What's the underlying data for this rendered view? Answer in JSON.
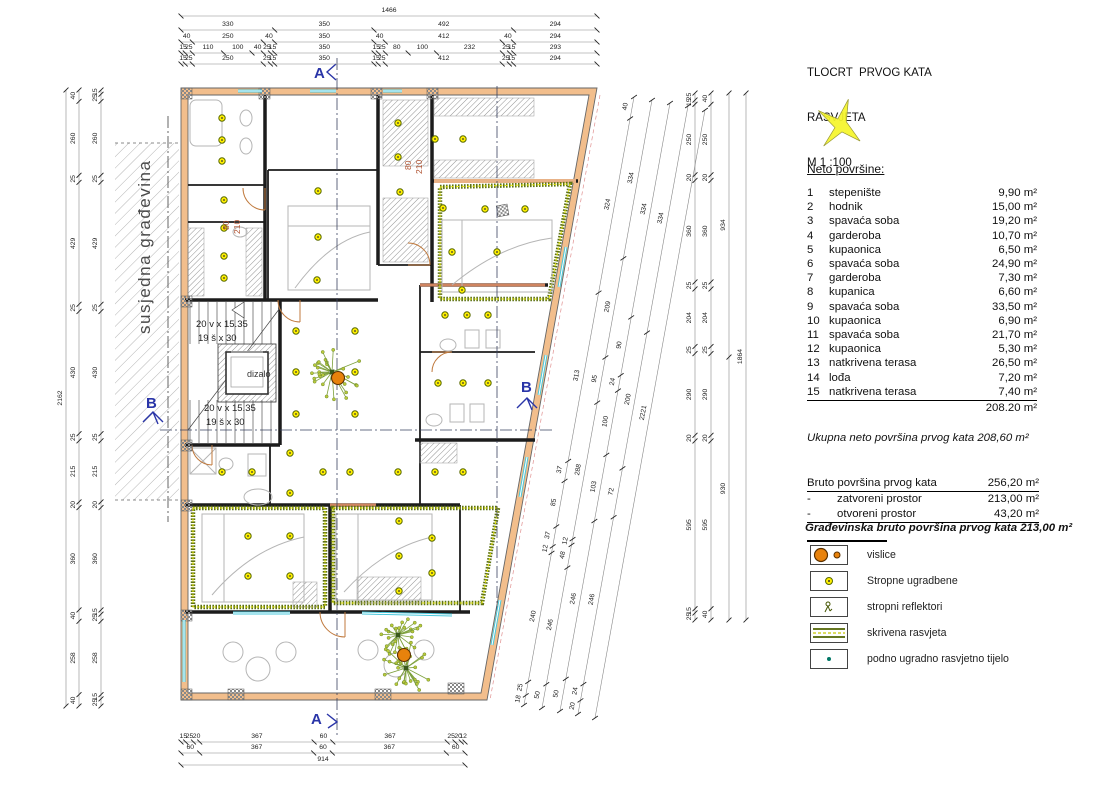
{
  "title": {
    "line1": "TLOCRT  PRVOG KATA",
    "line2": "RASVJETA",
    "scale": "M 1 :100"
  },
  "neto": {
    "heading": "Neto površine:",
    "rows": [
      {
        "num": "1",
        "name": "stepenište",
        "area": "9,90 m²"
      },
      {
        "num": "2",
        "name": "hodnik",
        "area": "15,00 m²"
      },
      {
        "num": "3",
        "name": "spavaća soba",
        "area": "19,20 m²"
      },
      {
        "num": "4",
        "name": "garderoba",
        "area": "10,70 m²"
      },
      {
        "num": "5",
        "name": "kupaonica",
        "area": "6,50 m²"
      },
      {
        "num": "6",
        "name": "spavaća soba",
        "area": "24,90 m²"
      },
      {
        "num": "7",
        "name": "garderoba",
        "area": "7,30 m²"
      },
      {
        "num": "8",
        "name": "kupanica",
        "area": "6,60 m²"
      },
      {
        "num": "9",
        "name": "spavaća soba",
        "area": "33,50 m²"
      },
      {
        "num": "10",
        "name": "kupaonica",
        "area": "6,90 m²"
      },
      {
        "num": "11",
        "name": "spavaća soba",
        "area": "21,70 m²"
      },
      {
        "num": "12",
        "name": "kupaonica",
        "area": "5,30 m²"
      },
      {
        "num": "13",
        "name": "natkrivena terasa",
        "area": "26,50 m²"
      },
      {
        "num": "14",
        "name": "lođa",
        "area": "7,20 m²"
      },
      {
        "num": "15",
        "name": "natkrivena terasa",
        "area": "7,40 m²"
      }
    ],
    "total": "208.20 m²"
  },
  "ukupna": "Ukupna neto površina  prvog kata  208,60 m²",
  "bruto": {
    "header": {
      "label": "Bruto površina prvog kata",
      "value": "256,20 m²"
    },
    "rows": [
      {
        "dash": "-",
        "label": "zatvoreni prostor",
        "value": "213,00 m²"
      },
      {
        "dash": "-",
        "label": "otvoreni prostor",
        "value": "43,20 m²"
      }
    ],
    "final": "Građevinska bruto površina prvog kata  213,00 m²"
  },
  "legend": {
    "items": [
      {
        "icon": "pendant-icon",
        "label": "vislice"
      },
      {
        "icon": "ceiling-recessed-icon",
        "label": "Stropne ugradbene"
      },
      {
        "icon": "spotlight-icon",
        "label": "stropni reflektori"
      },
      {
        "icon": "cove-lighting-icon",
        "label": "skrivena rasvjeta"
      },
      {
        "icon": "floor-light-icon",
        "label": "podno ugradno rasvjetno tijelo"
      }
    ]
  },
  "colors": {
    "wall": "#f2be8c",
    "wall_dark": "#cf8460",
    "light": "#ffef00",
    "cove": "#5f7313",
    "cove_dash": "#e8e80a",
    "window": "#49c8dc",
    "marker": "#2a35a8",
    "pendant": "#e8820c",
    "door": "#c07a3e",
    "dim": "#555555"
  },
  "plan": {
    "labels": [
      {
        "t": "A",
        "x": 314,
        "y": 78,
        "cls": "marker"
      },
      {
        "t": "A",
        "x": 311,
        "y": 724,
        "cls": "marker"
      },
      {
        "t": "B",
        "x": 146,
        "y": 408,
        "cls": "marker"
      },
      {
        "t": "B",
        "x": 521,
        "y": 392,
        "cls": "marker"
      },
      {
        "t": "dizalo",
        "x": 247,
        "y": 377,
        "cls": "small"
      },
      {
        "t": "20 v x 15.35",
        "x": 196,
        "y": 327,
        "cls": "stair"
      },
      {
        "t": "19 š x 30",
        "x": 198,
        "y": 341,
        "cls": "stair"
      },
      {
        "t": "20 v x 15.35",
        "x": 204,
        "y": 411,
        "cls": "stair"
      },
      {
        "t": "19 š x 30",
        "x": 206,
        "y": 425,
        "cls": "stair"
      },
      {
        "t": "80",
        "x": 229,
        "y": 230,
        "cls": "door",
        "rot": -90
      },
      {
        "t": "210",
        "x": 240,
        "y": 234,
        "cls": "door",
        "rot": -90
      },
      {
        "t": "80",
        "x": 411,
        "y": 170,
        "cls": "door",
        "rot": -90
      },
      {
        "t": "210",
        "x": 422,
        "y": 174,
        "cls": "door",
        "rot": -90
      },
      {
        "t": "susjedna građevina",
        "x": 150,
        "y": 334,
        "cls": "neighbor",
        "rot": -90
      }
    ],
    "dim_chains": [
      {
        "x1": 181,
        "y1": 16,
        "x2": 597,
        "y2": 16,
        "off": 4,
        "vals": [
          "1466"
        ]
      },
      {
        "x1": 181,
        "y1": 30,
        "x2": 597,
        "y2": 30,
        "off": 4,
        "vals": [
          "330",
          "350",
          "492",
          "294"
        ]
      },
      {
        "x1": 181,
        "y1": 42,
        "x2": 597,
        "y2": 42,
        "off": 4,
        "vals": [
          "40",
          "250",
          "40",
          "350",
          "40",
          "412",
          "40",
          "294"
        ]
      },
      {
        "x1": 181,
        "y1": 53,
        "x2": 597,
        "y2": 53,
        "off": 4,
        "vals": [
          "15",
          "25",
          "110",
          "100",
          "40",
          "25",
          "15",
          "350",
          "15",
          "25",
          "80",
          "100",
          "232",
          "25",
          "15",
          "293"
        ]
      },
      {
        "x1": 181,
        "y1": 64,
        "x2": 597,
        "y2": 64,
        "off": 4,
        "vals": [
          "15",
          "25",
          "250",
          "25",
          "15",
          "350",
          "15",
          "25",
          "412",
          "25",
          "15",
          "294"
        ]
      },
      {
        "x1": 66,
        "y1": 90,
        "x2": 66,
        "y2": 706,
        "off": -4,
        "vals": [
          "2162"
        ]
      },
      {
        "x1": 79,
        "y1": 90,
        "x2": 79,
        "y2": 706,
        "off": -4,
        "vals": [
          "40",
          "260",
          "25",
          "429",
          "25",
          "430",
          "25",
          "215",
          "20",
          "360",
          "40",
          "258",
          "40"
        ]
      },
      {
        "x1": 101,
        "y1": 90,
        "x2": 101,
        "y2": 706,
        "off": -4,
        "vals": [
          "15",
          "25",
          "260",
          "25",
          "429",
          "25",
          "430",
          "25",
          "215",
          "20",
          "360",
          "15",
          "25",
          "258",
          "15",
          "25"
        ]
      },
      {
        "x1": 695,
        "y1": 93,
        "x2": 695,
        "y2": 620,
        "off": -4,
        "vals": [
          "25",
          "15",
          "250",
          "20",
          "360",
          "25",
          "204",
          "25",
          "290",
          "20",
          "595",
          "15",
          "25"
        ]
      },
      {
        "x1": 711,
        "y1": 93,
        "x2": 711,
        "y2": 620,
        "off": -4,
        "vals": [
          "40",
          "250",
          "20",
          "360",
          "25",
          "204",
          "25",
          "290",
          "20",
          "595",
          "40"
        ]
      },
      {
        "x1": 729,
        "y1": 93,
        "x2": 729,
        "y2": 620,
        "off": -4,
        "vals": [
          "934",
          "930"
        ]
      },
      {
        "x1": 746,
        "y1": 93,
        "x2": 746,
        "y2": 620,
        "off": -4,
        "vals": [
          "1864"
        ]
      },
      {
        "x1": 181,
        "y1": 742,
        "x2": 465,
        "y2": 742,
        "off": 4,
        "vals": [
          "15",
          "25",
          "20",
          "367",
          "60",
          "367",
          "25",
          "20",
          "12"
        ]
      },
      {
        "x1": 181,
        "y1": 753,
        "x2": 465,
        "y2": 753,
        "off": 4,
        "vals": [
          "60",
          "367",
          "60",
          "367",
          "60"
        ]
      },
      {
        "x1": 181,
        "y1": 765,
        "x2": 465,
        "y2": 765,
        "off": 4,
        "vals": [
          "914"
        ]
      },
      {
        "x1": 634,
        "y1": 97,
        "x2": 524,
        "y2": 705,
        "off": -5,
        "vals": [
          "40",
          "324",
          "313",
          "37",
          "85",
          "37",
          "12",
          "240",
          "25",
          "18"
        ]
      },
      {
        "x1": 652,
        "y1": 100,
        "x2": 542,
        "y2": 708,
        "off": -5,
        "vals": [
          "334",
          "209",
          "95",
          "288",
          "12",
          "48",
          "246",
          "50"
        ]
      },
      {
        "x1": 670,
        "y1": 103,
        "x2": 560,
        "y2": 711,
        "off": -5,
        "vals": [
          "334",
          "90",
          "24",
          "100",
          "103",
          "246",
          "50"
        ]
      },
      {
        "x1": 688,
        "y1": 106,
        "x2": 578,
        "y2": 714,
        "off": -5,
        "vals": [
          "334",
          "200",
          "72",
          "246",
          "24",
          "20"
        ]
      },
      {
        "x1": 705,
        "y1": 110,
        "x2": 595,
        "y2": 718,
        "off": -5,
        "vals": [
          "2221"
        ]
      }
    ],
    "lights": [
      [
        222,
        118
      ],
      [
        222,
        140
      ],
      [
        222,
        161
      ],
      [
        224,
        200
      ],
      [
        224,
        228
      ],
      [
        224,
        256
      ],
      [
        224,
        278
      ],
      [
        318,
        191
      ],
      [
        318,
        237
      ],
      [
        317,
        280
      ],
      [
        398,
        123
      ],
      [
        398,
        157
      ],
      [
        400,
        192
      ],
      [
        435,
        139
      ],
      [
        463,
        139
      ],
      [
        443,
        208
      ],
      [
        485,
        209
      ],
      [
        525,
        209
      ],
      [
        452,
        252
      ],
      [
        497,
        252
      ],
      [
        462,
        290
      ],
      [
        296,
        331
      ],
      [
        355,
        331
      ],
      [
        296,
        372
      ],
      [
        355,
        372
      ],
      [
        296,
        414
      ],
      [
        355,
        414
      ],
      [
        445,
        315
      ],
      [
        467,
        315
      ],
      [
        488,
        315
      ],
      [
        438,
        383
      ],
      [
        463,
        383
      ],
      [
        488,
        383
      ],
      [
        222,
        472
      ],
      [
        252,
        472
      ],
      [
        290,
        453
      ],
      [
        290,
        493
      ],
      [
        323,
        472
      ],
      [
        350,
        472
      ],
      [
        398,
        472
      ],
      [
        435,
        472
      ],
      [
        463,
        472
      ],
      [
        248,
        536
      ],
      [
        248,
        576
      ],
      [
        290,
        536
      ],
      [
        290,
        576
      ],
      [
        399,
        521
      ],
      [
        432,
        538
      ],
      [
        399,
        556
      ],
      [
        432,
        573
      ],
      [
        399,
        591
      ]
    ],
    "pendants": [
      [
        338,
        378
      ],
      [
        404,
        655
      ]
    ],
    "windows": [
      [
        238,
        91,
        262,
        91
      ],
      [
        310,
        91,
        336,
        91
      ],
      [
        383,
        91,
        402,
        91
      ],
      [
        233,
        613,
        290,
        613
      ],
      [
        362,
        613,
        452,
        615
      ],
      [
        184,
        620,
        184,
        682
      ],
      [
        566,
        247,
        559,
        287
      ],
      [
        546,
        355,
        539,
        395
      ],
      [
        527,
        457,
        520,
        497
      ],
      [
        500,
        600,
        492,
        645
      ]
    ]
  }
}
